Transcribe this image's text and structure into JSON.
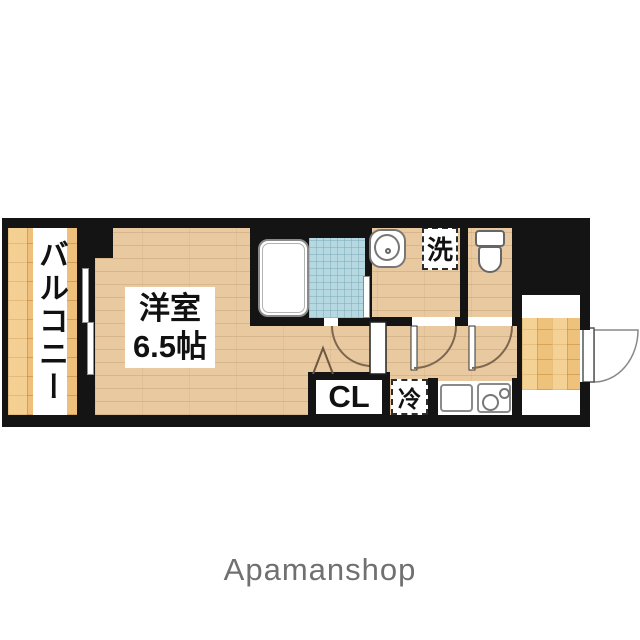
{
  "floorplan": {
    "balcony": {
      "label": "バルコニー"
    },
    "main_room": {
      "name": "洋室",
      "size": "6.5帖"
    },
    "closet": {
      "label": "CL"
    },
    "refrigerator": {
      "label": "冷"
    },
    "washer": {
      "label": "洗"
    },
    "colors": {
      "wall": "#141414",
      "wood_floor": "#e9c9a0",
      "balcony_tile": "#eec07c",
      "entrance_tile": "#eec27b",
      "bath_tile": "#b6d9e1",
      "door_swing_line": "#7d6750",
      "brand_text": "#707070"
    }
  },
  "footer": {
    "brand": "Apamanshop"
  }
}
